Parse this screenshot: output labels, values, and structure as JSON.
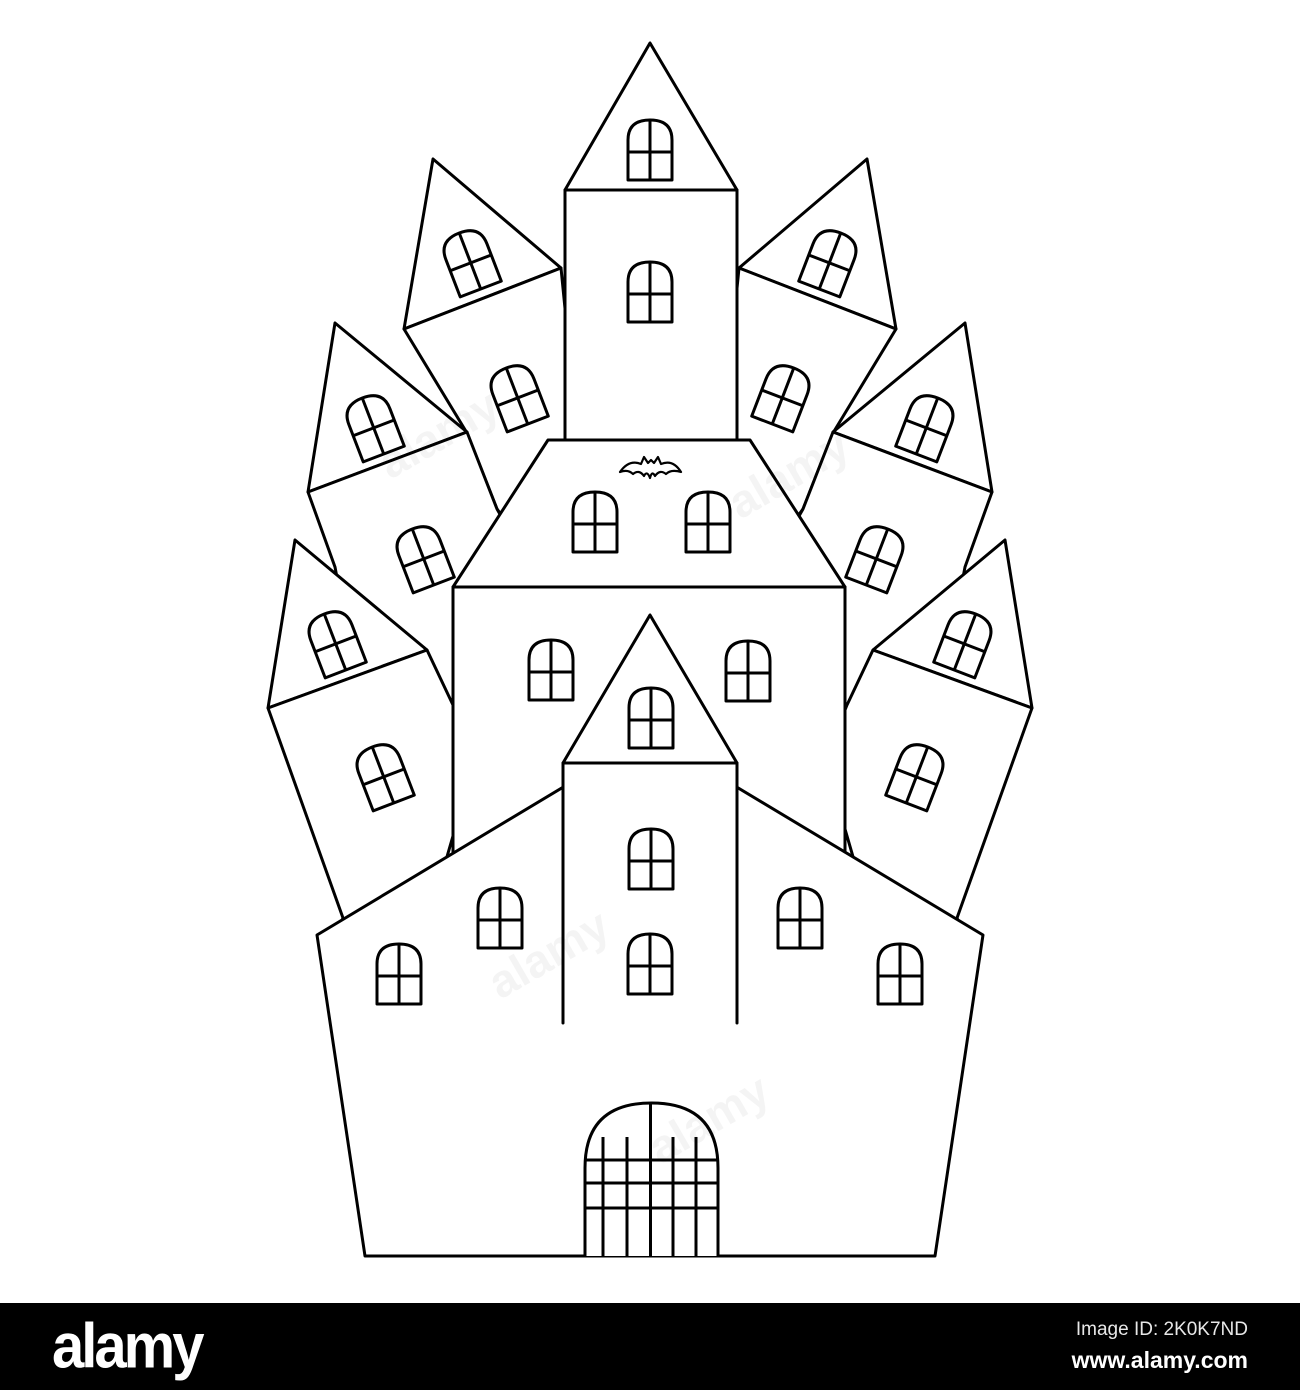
{
  "image": {
    "width": 1300,
    "height": 1390,
    "background": "#ffffff"
  },
  "footer": {
    "background": "#000000",
    "logo": "alamy",
    "image_id": "Image ID: 2K0K7ND",
    "url": "www.alamy.com",
    "text_color": "#ffffff"
  },
  "illustration": {
    "subject": "haunted-castle-line-art-coloring-page",
    "stroke_color": "#000000",
    "fill_color": "#ffffff",
    "stroke_width": 3,
    "canvas": {
      "width": 1300,
      "height": 1303
    },
    "shapes": [
      {
        "name": "upper-left-tower-roof",
        "points": "433,159 404,329 561,268"
      },
      {
        "name": "upper-left-tower-body",
        "points": "404,329 561,268 580,460 520,540 497,509 467,433"
      },
      {
        "name": "upper-right-tower-roof",
        "points": "867,159 896,329 739,268"
      },
      {
        "name": "upper-right-tower-body",
        "points": "896,329 739,268 720,460 780,540 803,509 833,433"
      },
      {
        "name": "central-tower-body",
        "points": "565,190 737,190 737,440 565,440"
      },
      {
        "name": "central-tower-roof",
        "points": "650,43 565,190 737,190"
      },
      {
        "name": "mid-left-tower-roof",
        "points": "335,323 308,492 467,432"
      },
      {
        "name": "mid-left-tower-body",
        "points": "308,492 467,432 497,509 560,620 470,760 360,700 335,567"
      },
      {
        "name": "mid-right-tower-roof",
        "points": "965,323 992,492 833,432"
      },
      {
        "name": "mid-right-tower-body",
        "points": "992,492 833,432 803,509 740,620 830,760 940,700 965,567"
      },
      {
        "name": "lower-left-tower-roof",
        "points": "295,540 268,708 427,650"
      },
      {
        "name": "lower-left-tower-body",
        "points": "268,708 427,650 453,705 475,760 420,950 330,950 343,918"
      },
      {
        "name": "lower-right-tower-roof",
        "points": "1005,540 1032,708 873,650"
      },
      {
        "name": "lower-right-tower-body",
        "points": "1032,708 873,650 847,705 825,760 880,950 970,950 957,918"
      },
      {
        "name": "middle-building-roof",
        "points": "548,440 750,440 845,587 453,587"
      },
      {
        "name": "middle-building-body",
        "points": "453,587 845,587 845,940 453,940"
      },
      {
        "name": "main-building",
        "points": "365,1256 317,935 650,735 983,935 935,1256"
      },
      {
        "name": "front-tower-body",
        "points": "563,763 737,763 737,1023 563,1023",
        "stroke": false
      },
      {
        "name": "front-tower-roof",
        "points": "650,615 563,763 737,763"
      }
    ],
    "lines": [
      {
        "name": "front-tower-left-edge",
        "x1": 563,
        "y1": 763,
        "x2": 563,
        "y2": 1023
      },
      {
        "name": "front-tower-right-edge",
        "x1": 737,
        "y1": 763,
        "x2": 737,
        "y2": 1023
      }
    ],
    "windows": {
      "width": 44,
      "height": 60,
      "arch_height": 20,
      "crossbar_from_top": 32,
      "items": [
        {
          "name": "central-roof-window",
          "cx": 650,
          "cy": 150,
          "rot": 0
        },
        {
          "name": "central-body-window",
          "cx": 650,
          "cy": 292,
          "rot": 0
        },
        {
          "name": "upper-left-roof-window",
          "cx": 470,
          "cy": 261,
          "rot": -21
        },
        {
          "name": "upper-left-body-window",
          "cx": 517,
          "cy": 396,
          "rot": -21
        },
        {
          "name": "upper-right-roof-window",
          "cx": 830,
          "cy": 261,
          "rot": 21
        },
        {
          "name": "upper-right-body-window",
          "cx": 783,
          "cy": 396,
          "rot": 21
        },
        {
          "name": "mid-left-roof-window",
          "cx": 373,
          "cy": 426,
          "rot": -21
        },
        {
          "name": "mid-left-body-window",
          "cx": 423,
          "cy": 557,
          "rot": -21
        },
        {
          "name": "mid-right-roof-window",
          "cx": 927,
          "cy": 426,
          "rot": 21
        },
        {
          "name": "mid-right-body-window",
          "cx": 877,
          "cy": 557,
          "rot": 21
        },
        {
          "name": "lower-left-roof-window",
          "cx": 335,
          "cy": 642,
          "rot": -21
        },
        {
          "name": "lower-left-body-window",
          "cx": 383,
          "cy": 775,
          "rot": -21
        },
        {
          "name": "lower-right-roof-window",
          "cx": 965,
          "cy": 642,
          "rot": 21
        },
        {
          "name": "lower-right-body-window",
          "cx": 917,
          "cy": 775,
          "rot": 21
        },
        {
          "name": "middle-roof-left-window",
          "cx": 595,
          "cy": 522,
          "rot": 0
        },
        {
          "name": "middle-roof-right-window",
          "cx": 708,
          "cy": 522,
          "rot": 0
        },
        {
          "name": "middle-body-left-window",
          "cx": 551,
          "cy": 670,
          "rot": 0
        },
        {
          "name": "middle-body-right-window",
          "cx": 748,
          "cy": 671,
          "rot": 0
        },
        {
          "name": "front-tower-roof-window",
          "cx": 651,
          "cy": 718,
          "rot": 0
        },
        {
          "name": "front-tower-upper-window",
          "cx": 651,
          "cy": 859,
          "rot": 0
        },
        {
          "name": "front-tower-lower-window",
          "cx": 650,
          "cy": 964,
          "rot": 0
        },
        {
          "name": "main-left-outer-window",
          "cx": 399,
          "cy": 974,
          "rot": 0
        },
        {
          "name": "main-left-inner-window",
          "cx": 500,
          "cy": 918,
          "rot": 0
        },
        {
          "name": "main-right-inner-window",
          "cx": 800,
          "cy": 918,
          "rot": 0
        },
        {
          "name": "main-right-outer-window",
          "cx": 900,
          "cy": 974,
          "rot": 0
        }
      ]
    },
    "gate": {
      "arch_path": "M 585 1256 L 585 1168 Q 585 1103 651.5 1103 Q 718 1103 718 1168 L 718 1256",
      "bottom_y": 1256,
      "vertical_bars": [
        {
          "x": 603,
          "y_top": 1137
        },
        {
          "x": 627,
          "y_top": 1137
        },
        {
          "x": 650.5,
          "y_top": 1104
        },
        {
          "x": 673,
          "y_top": 1137
        },
        {
          "x": 696,
          "y_top": 1137
        }
      ],
      "horizontal_bars": [
        {
          "y": 1160,
          "x1": 585,
          "x2": 718
        },
        {
          "y": 1183,
          "x1": 585,
          "x2": 718
        },
        {
          "y": 1208,
          "x1": 585,
          "x2": 718
        }
      ]
    },
    "bat": {
      "d": "M 620 472 Q 629 459 641 464 L 644 457 L 648 463 L 651 460 L 654 463 L 658 457 L 661 464 Q 673 459 681 472 Q 671 469 666 474 Q 660 469 655 476 Q 652 470 650 478 Q 647 470 644 476 Q 639 469 633 474 Q 628 469 620 472 Z"
    },
    "watermarks": [
      {
        "x": 390,
        "y": 480,
        "size": 46,
        "rotation": -30,
        "opacity": 0.04,
        "text": "alamy"
      },
      {
        "x": 740,
        "y": 520,
        "size": 46,
        "rotation": -30,
        "opacity": 0.04,
        "text": "alamy"
      },
      {
        "x": 500,
        "y": 1000,
        "size": 46,
        "rotation": -30,
        "opacity": 0.04,
        "text": "alamy"
      },
      {
        "x": 660,
        "y": 1165,
        "size": 46,
        "rotation": -30,
        "opacity": 0.04,
        "text": "alamy"
      }
    ]
  }
}
